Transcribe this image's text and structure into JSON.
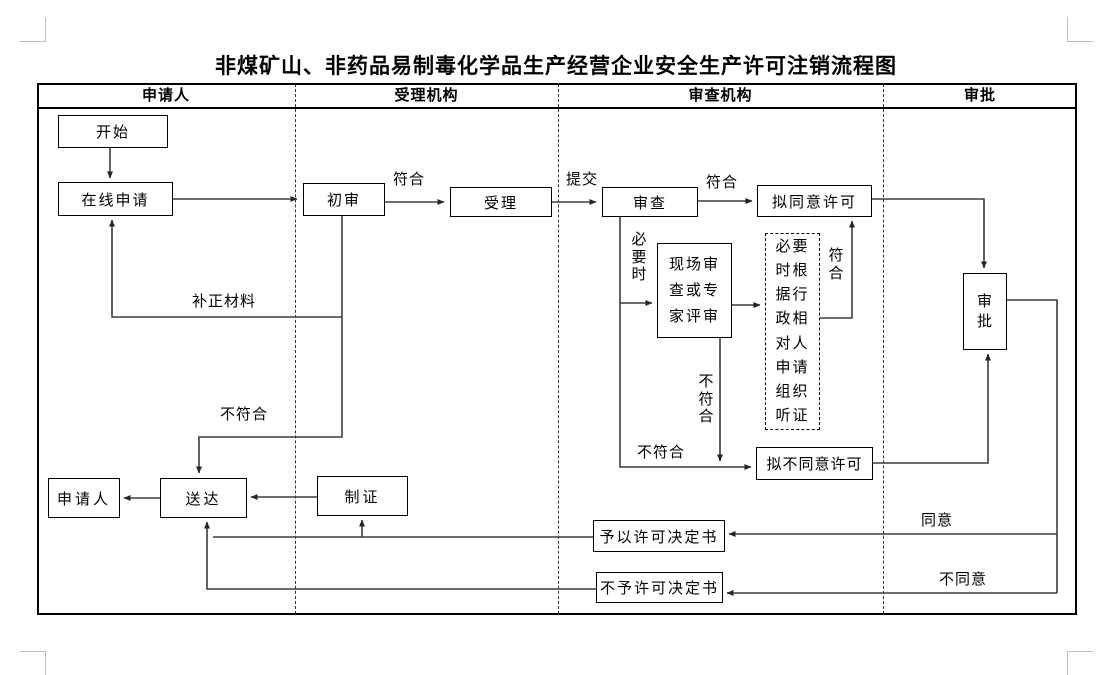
{
  "page": {
    "title": "非煤矿山、非药品易制毒化学品生产经营企业安全生产许可注销流程图"
  },
  "lanes": [
    {
      "label": "申请人"
    },
    {
      "label": "受理机构"
    },
    {
      "label": "审查机构"
    },
    {
      "label": "审批"
    }
  ],
  "nodes": {
    "start": "开始",
    "online_apply": "在线申请",
    "initial_review": "初审",
    "accept": "受理",
    "review": "审查",
    "propose_approve": "拟同意许可",
    "onsite_review": "现场审查或专家评审",
    "hearing": "必要时根据行政相对人申请组织听证",
    "propose_reject": "拟不同意许可",
    "approval": "审批",
    "grant_decision": "予以许可决定书",
    "deny_decision": "不予许可决定书",
    "applicant": "申请人",
    "deliver": "送达",
    "make_cert": "制证"
  },
  "edge_labels": {
    "conform_initial": "符合",
    "submit": "提交",
    "conform_review": "符合",
    "when_necessary": "必要时",
    "conform_hearing": "符合",
    "not_conform_onsite": "不符合",
    "not_conform_review": "不符合",
    "supplement_materials": "补正材料",
    "not_conform_initial": "不符合",
    "agree": "同意",
    "disagree": "不同意"
  }
}
